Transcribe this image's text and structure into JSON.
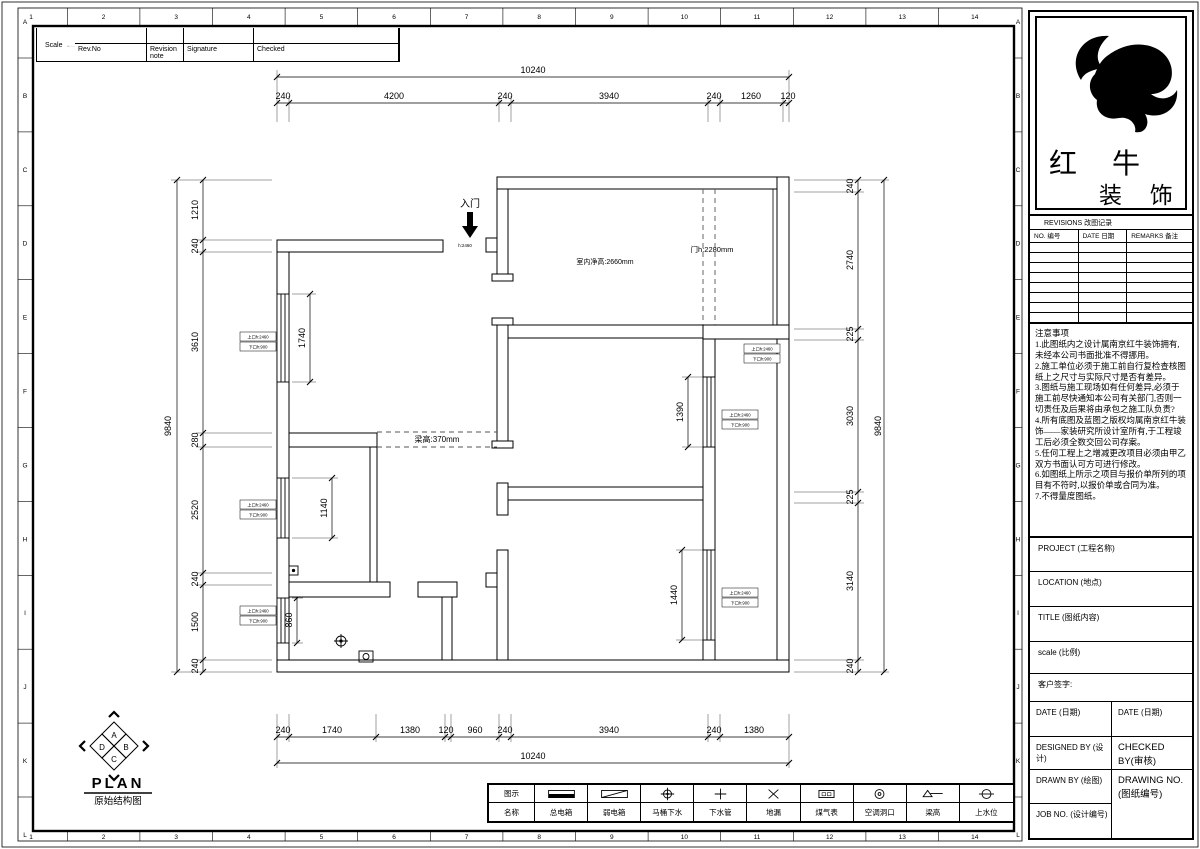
{
  "sheet": {
    "bg": "#ffffff",
    "line_color": "#000000"
  },
  "ruler": {
    "columns": [
      "1",
      "2",
      "3",
      "4",
      "5",
      "6",
      "7",
      "8",
      "9",
      "10",
      "11",
      "12",
      "13",
      "14"
    ],
    "rows": [
      "A",
      "B",
      "C",
      "D",
      "E",
      "F",
      "G",
      "H",
      "I",
      "J",
      "K",
      "L"
    ]
  },
  "revision_strip": {
    "headers": [
      "Rev.No",
      "Revision note",
      "Signature",
      "Checked"
    ],
    "scale_label": "Scale"
  },
  "brand": {
    "name_top": "红 牛",
    "name_bottom": "装 饰"
  },
  "revisions": {
    "title": "REVISIONS 改图记录",
    "headers": [
      "NO. 编号",
      "DATE 日期",
      "REMARKS 备注"
    ],
    "empty_row_count": 8
  },
  "notes": {
    "title": "注意事项",
    "items": [
      "1.此图纸内之设计属南京红牛装饰拥有,未经本公司书面批准不得挪用。",
      "2.施工单位必须于施工前自行复检查核图纸上之尺寸与实际尺寸是否有差异。",
      "3.图纸与施工现场如有任何差异,必须于施工前尽快通知本公司有关部门,否则一切责任及后果将由承包之施工队负责?",
      "4.所有底图及蓝图之版权均属南京红牛装饰——家装研究所设计室所有,于工程竣工后必须全数交回公司存案。",
      "5.任何工程上之增减更改项目必须由甲乙双方书面认可方可进行修改。",
      "6.如图纸上所示之项目与报价单所列的项目有不符时,以报价单或合同为准。",
      "7.不得量度图纸。"
    ]
  },
  "title_block": {
    "project_label": "PROJECT (工程名称)",
    "location_label": "LOCATION (地点)",
    "title_label": "TITLE (图纸内容)",
    "scale_label": "scale (比例)",
    "client_label": "客户签字:",
    "date_left_label": "DATE (日期)",
    "date_right_label": "DATE (日期)",
    "designed_label": "DESIGNED BY (设计)",
    "checked_label": "CHECKED BY(审核)",
    "drawn_label": "DRAWN BY (绘图)",
    "drawing_no_label": "DRAWING NO.(图纸编号)",
    "job_no_label": "JOB NO. (设计编号)"
  },
  "plan": {
    "title": "PLAN",
    "subtitle": "原始结构图",
    "compass": {
      "n": "A",
      "e": "B",
      "s": "C",
      "w": "D"
    },
    "entry_label": "入门",
    "entry_note": "h:2460",
    "interior_height_note": "室内净高:2660mm",
    "door_height_note": "门h:2280mm",
    "beam_note": "梁高:370mm",
    "window_label": {
      "l1": "上口h:2460",
      "l2": "下口h:900"
    },
    "dims": {
      "top_total": "10240",
      "top": [
        "240",
        "4200",
        "240",
        "3940",
        "240",
        "1260",
        "120"
      ],
      "bottom": [
        "240",
        "1740",
        "1380",
        "120",
        "960",
        "240",
        "3940",
        "240",
        "1380"
      ],
      "bottom_total": "10240",
      "left_total": "9840",
      "left": [
        "1210",
        "240",
        "3610",
        "280",
        "2520",
        "240",
        "1500",
        "240"
      ],
      "right": [
        "240",
        "2740",
        "225",
        "3030",
        "225",
        "3140",
        "240"
      ],
      "right_total": "9840",
      "interior": {
        "left_window_top": "1740",
        "left_window_mid": "1140",
        "left_window_bottom": "860",
        "right_window_top": "1390",
        "right_window_bottom": "1440"
      }
    }
  },
  "legend": {
    "symbol_header": "图示",
    "name_header": "名称",
    "items": [
      {
        "name": "总电箱"
      },
      {
        "name": "弱电箱"
      },
      {
        "name": "马桶下水"
      },
      {
        "name": "下水管"
      },
      {
        "name": "地漏"
      },
      {
        "name": "煤气表"
      },
      {
        "name": "空调洞口"
      },
      {
        "name": "梁高"
      },
      {
        "name": "上水位"
      }
    ]
  }
}
